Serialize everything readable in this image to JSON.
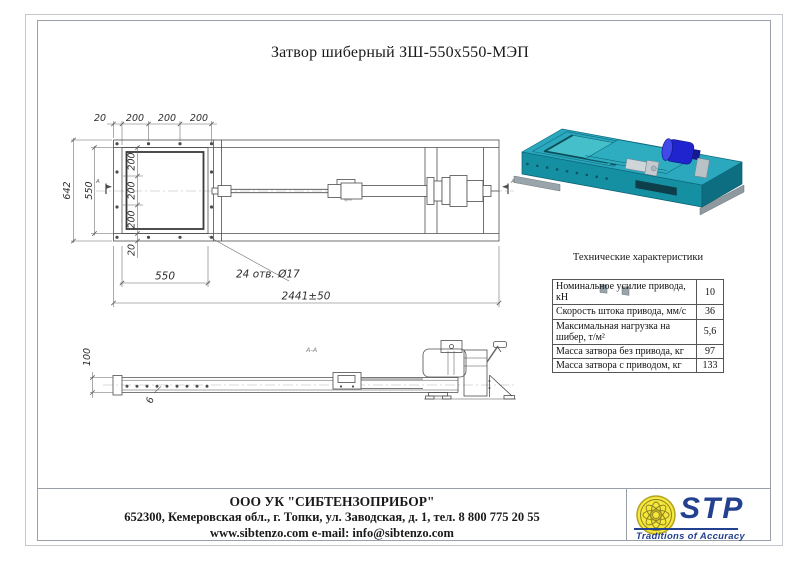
{
  "title": "Затвор шиберный ЗШ-550х550-МЭП",
  "drawing": {
    "plan": {
      "top_dims": [
        "20",
        "200",
        "200",
        "200"
      ],
      "overall_height": "642",
      "opening_height": "550",
      "row_dims": [
        "200",
        "200",
        "200"
      ],
      "edge_dim": "20",
      "flange_width": "550",
      "holes_note": "24 отв. Ø17",
      "overall_length": "2441±50",
      "section_letter": "А"
    },
    "side": {
      "height_dim": "100",
      "thickness_dim": "6",
      "section_title": "А-А"
    }
  },
  "specs": {
    "heading": "Технические характеристики",
    "rows": [
      {
        "label": "Номинальное усилие привода, кН",
        "value": "10"
      },
      {
        "label": "Скорость штока привода, мм/с",
        "value": "36"
      },
      {
        "label": "Максимальная нагрузка на шибер, т/м²",
        "value": "5,6"
      },
      {
        "label": "Масса затвора без привода, кг",
        "value": "97"
      },
      {
        "label": "Масса затвора с приводом, кг",
        "value": "133"
      }
    ]
  },
  "footer": {
    "company": "ООО УК \"СИБТЕНЗОПРИБОР\"",
    "address": "652300, Кемеровская обл., г. Топки, ул. Заводская, д. 1, тел. 8 800 775 20 55",
    "web": "www.sibtenzo.com e-mail: info@sibtenzo.com"
  },
  "logo": {
    "abbr": "STP",
    "tagline": "Traditions of Accuracy"
  },
  "colors": {
    "logo_blue": "#23418e",
    "emblem_yellow": "#f6e73c",
    "render_teal": "#2ba8bd",
    "render_motor_blue": "#1f24cf"
  }
}
